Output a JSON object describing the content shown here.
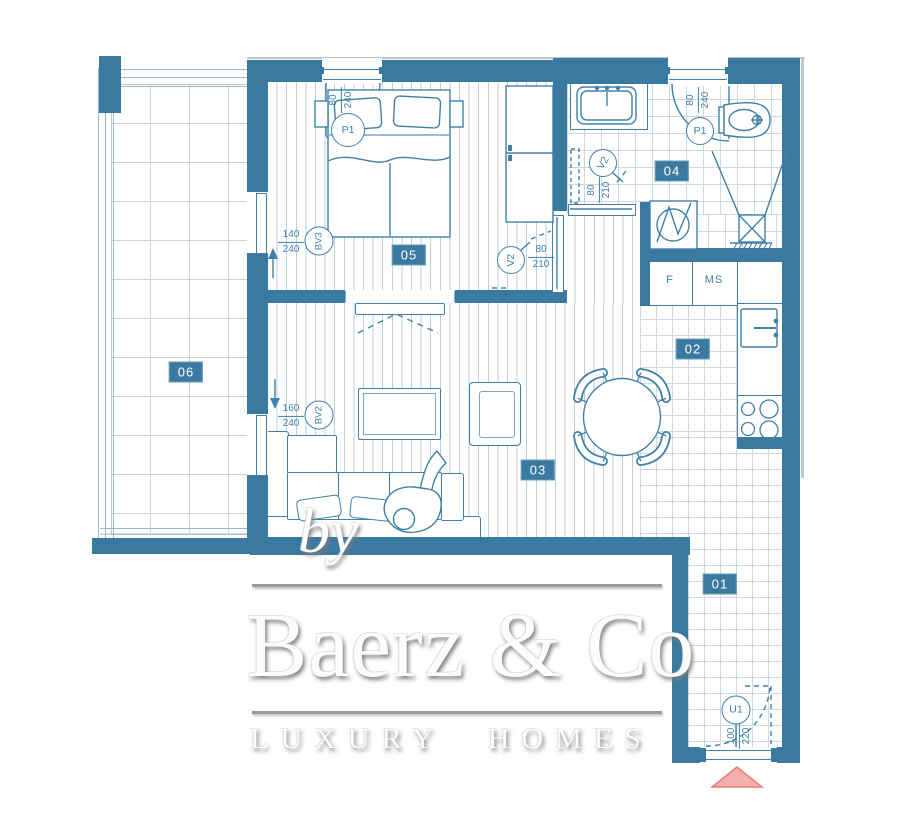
{
  "watermark": {
    "by": "by",
    "brand": "Baerz & Co",
    "tagline": "LUXURY HOMES"
  },
  "rooms": {
    "r01": "01",
    "r02": "02",
    "r03": "03",
    "r04": "04",
    "r05": "05",
    "r06": "06"
  },
  "labels": {
    "p1_bedroom": "P1",
    "p1_bath": "P1",
    "v2_bedroom": "V2",
    "v2_bath": "V2",
    "bv3": "BV3",
    "bv2": "BV2",
    "u1": "U1"
  },
  "dims": {
    "p1_bedroom": {
      "w": "80",
      "h": "240"
    },
    "p1_bath": {
      "w": "80",
      "h": "240"
    },
    "v2_bedroom": {
      "w": "80",
      "h": "210"
    },
    "v2_bath": {
      "w": "80",
      "h": "210"
    },
    "bv3": {
      "w": "140",
      "h": "240"
    },
    "bv2": {
      "w": "160",
      "h": "240"
    },
    "u1": {
      "w": "100",
      "h": "220"
    }
  },
  "kitchen": {
    "fridge": "F",
    "cabinet": "MS"
  },
  "colors": {
    "wall": "#3b7aa0",
    "line": "#4080a8",
    "entrance_pink": "#f5b0ad",
    "watermark_gray": "#9b9b9b"
  }
}
